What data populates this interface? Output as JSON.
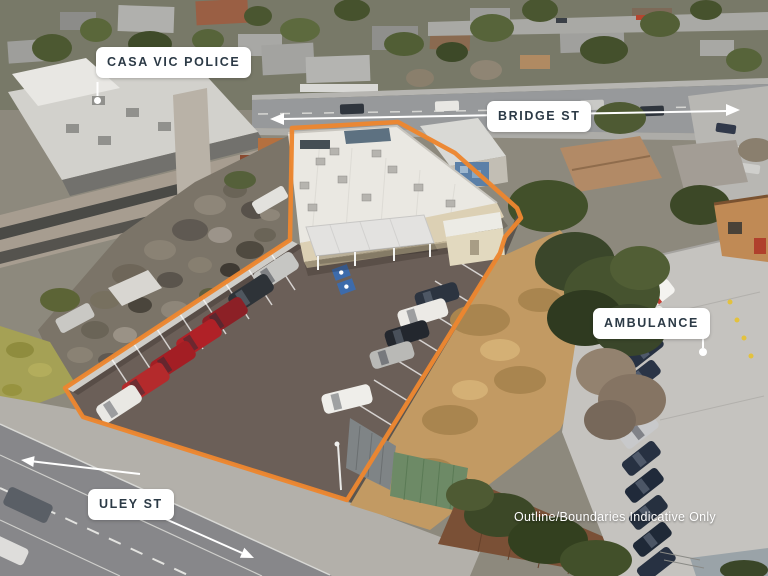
{
  "labels": {
    "casa": {
      "text": "CASA VIC POLICE"
    },
    "bridge": {
      "text": "BRIDGE ST"
    },
    "ambulance": {
      "text": "AMBULANCE"
    },
    "uley": {
      "text": "ULEY ST"
    }
  },
  "disclaimer": {
    "text": "Outline/Boundaries Indicative Only"
  },
  "colors": {
    "boundary-orange": "#EC8630",
    "label-bg": "#FFFFFF",
    "label-text": "#2C3A46",
    "overlay-white": "#FFFFFF"
  }
}
